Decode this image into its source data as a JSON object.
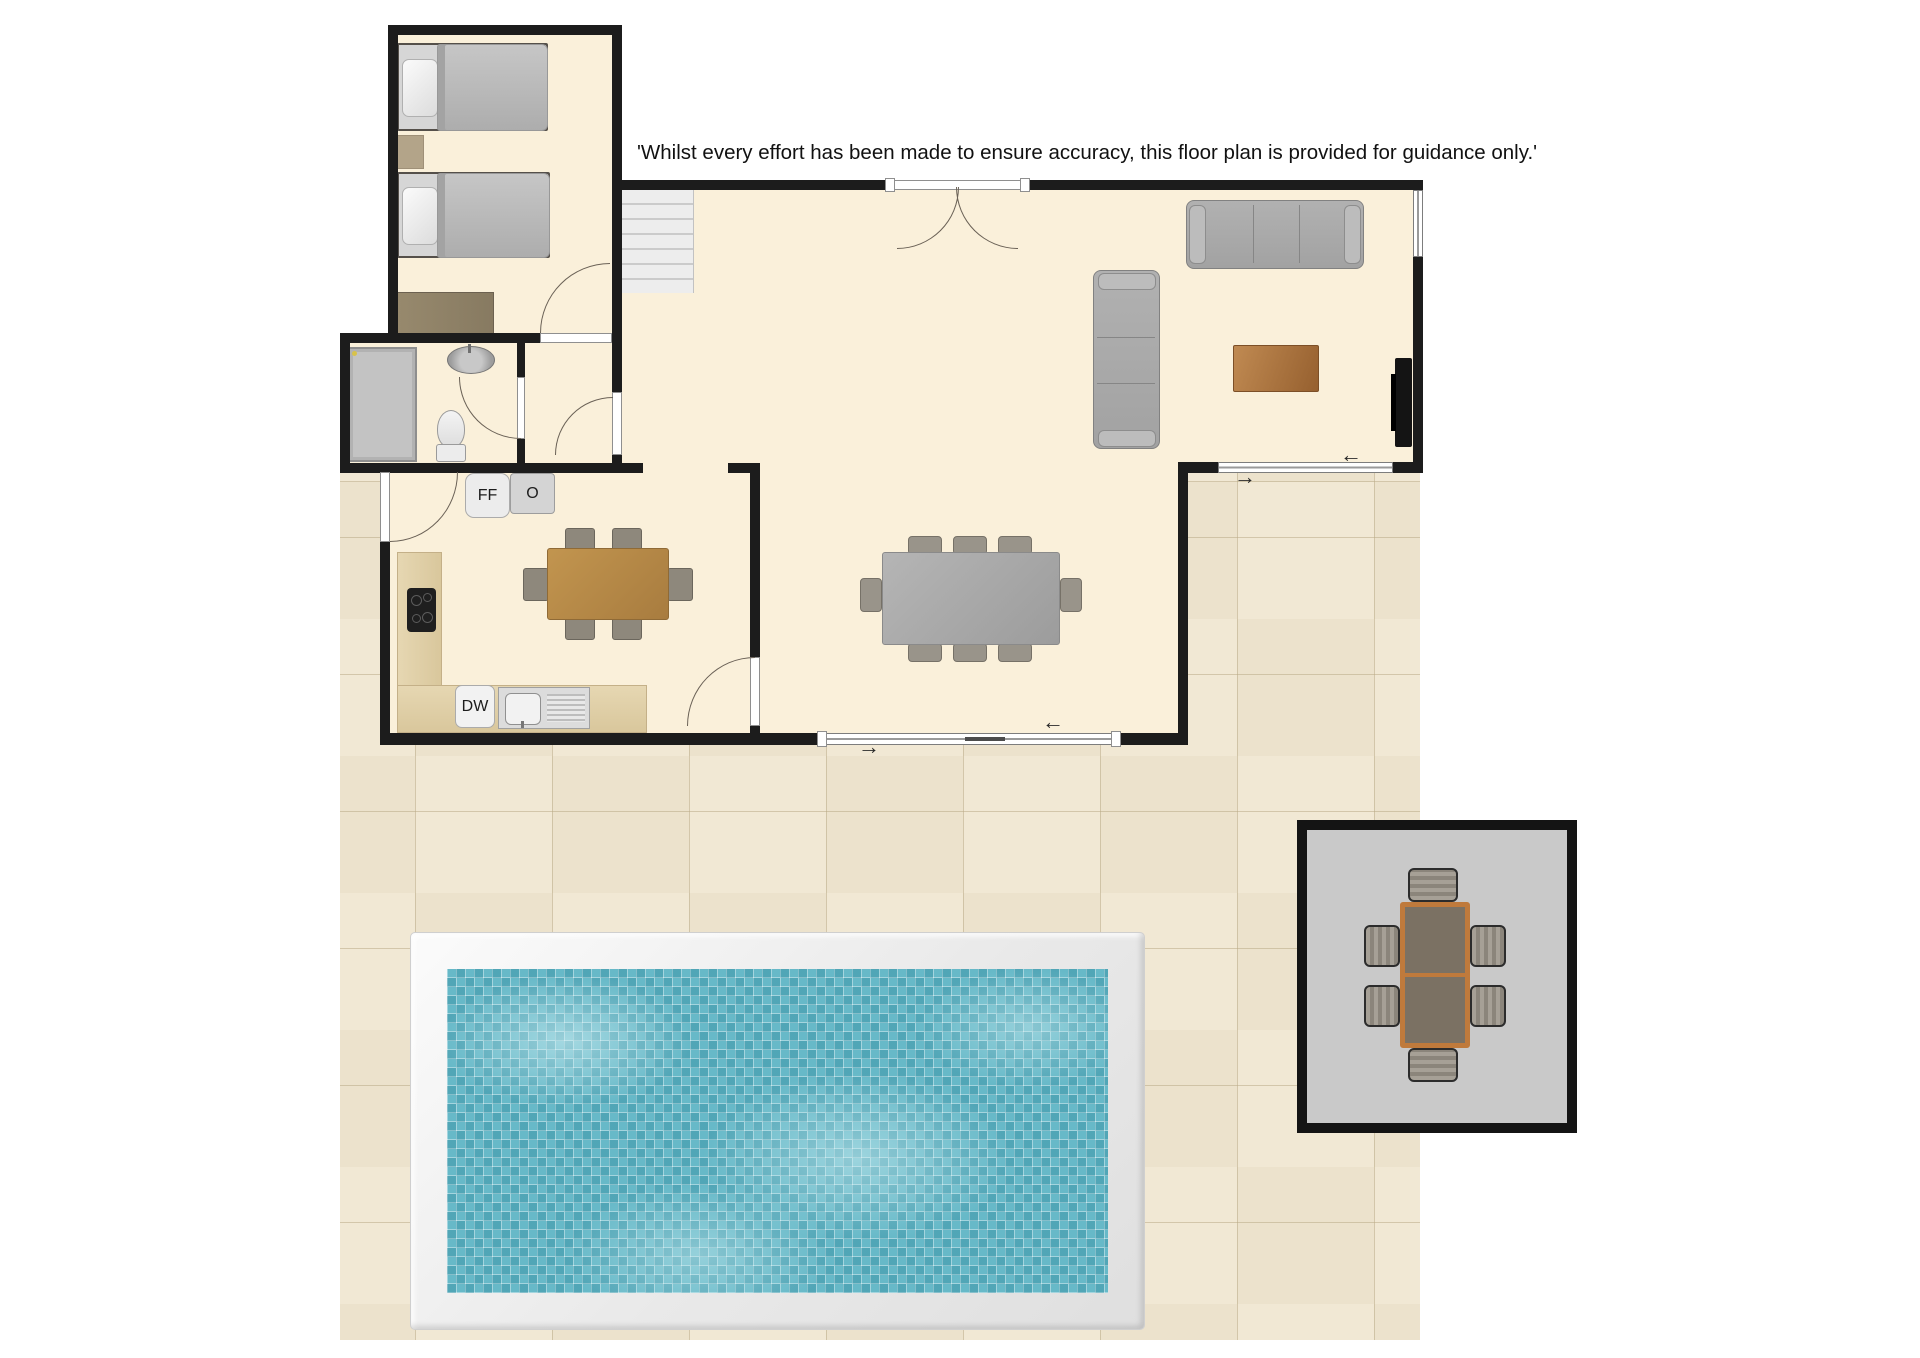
{
  "disclaimer": {
    "text": "'Whilst every effort has been made to ensure accuracy, this floor plan is provided for guidance only.'"
  },
  "kitchen": {
    "fridge_freezer_label": "FF",
    "oven_label": "O",
    "dishwasher_label": "DW"
  },
  "arrows": {
    "left": "←",
    "right": "→"
  },
  "colors": {
    "wall": "#1c1c1c",
    "interior_floor": "#faf0da",
    "patio_tile": "#f0e7d2",
    "pool_water": "#5fb5c5",
    "pool_surround": "#f0f0f0",
    "terrace_slab": "#c9c9c9",
    "wood_table": "#b78a4e",
    "sofa_gray": "#a8a8a8"
  },
  "floorplan": {
    "rooms": [
      {
        "name": "bedroom",
        "furniture": [
          "single-bed",
          "single-bed",
          "rug",
          "dresser"
        ]
      },
      {
        "name": "bathroom",
        "furniture": [
          "shower",
          "sink",
          "toilet"
        ]
      },
      {
        "name": "hallway",
        "furniture": []
      },
      {
        "name": "kitchen-diner",
        "furniture": [
          "fridge-freezer",
          "oven",
          "hob",
          "counter",
          "dishwasher",
          "sink-drainer",
          "table-for-6"
        ]
      },
      {
        "name": "living-dining-room",
        "furniture": [
          "stairs",
          "double-doors",
          "sofa-3-seat",
          "sofa-3-seat",
          "coffee-table",
          "tv",
          "table-for-8",
          "sliding-door",
          "window"
        ]
      }
    ],
    "outdoor": [
      {
        "name": "patio",
        "features": [
          "tiled-paving"
        ]
      },
      {
        "name": "swimming-pool",
        "features": [
          "white-surround",
          "mosaic-water"
        ]
      },
      {
        "name": "dining-terrace",
        "features": [
          "outdoor-table",
          "six-chairs"
        ]
      }
    ]
  }
}
